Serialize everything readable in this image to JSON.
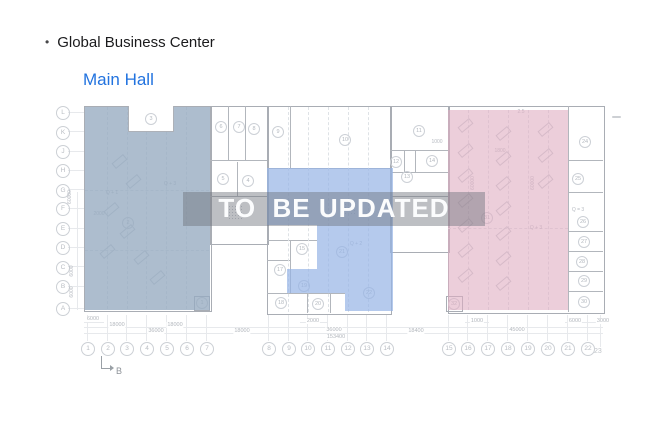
{
  "header": {
    "bullet": "•",
    "title": "Global Business Center",
    "subtitle": "Main Hall"
  },
  "watermark": "TO  BE UPDATED",
  "grid": {
    "letters": [
      "L",
      "K",
      "J",
      "H",
      "G",
      "F",
      "E",
      "D",
      "C",
      "B",
      "A"
    ],
    "numbers": [
      "1",
      "2",
      "3",
      "4",
      "5",
      "6",
      "7",
      "8",
      "9",
      "10",
      "11",
      "12",
      "13",
      "14",
      "15",
      "16",
      "17",
      "18",
      "19",
      "20",
      "21",
      "22",
      "23"
    ]
  },
  "rooms": {
    "r1": "1",
    "r2": "2",
    "r3": "3",
    "r4": "4",
    "r5": "5",
    "r6": "6",
    "r7": "7",
    "r8": "8",
    "r9": "9",
    "r10": "10",
    "r11": "11",
    "r12": "12",
    "r13": "13",
    "r14": "14",
    "r15": "15",
    "r17": "17",
    "r18": "18",
    "r19": "19",
    "r20": "20",
    "r21": "21",
    "r22": "22",
    "r24": "24",
    "r25": "25",
    "r26": "26",
    "r27": "27",
    "r28": "28",
    "r29": "29",
    "r30": "30",
    "r31": "31",
    "r32": "32"
  },
  "area_labels": {
    "left_a": "Q + 3",
    "left_b": "Q + 1",
    "middle": "Q + 2",
    "pink": "Q + 3",
    "right_col": "Q = 3"
  },
  "dims": {
    "left_offset": "6000",
    "left_seg1": "18000",
    "left_seg2": "18000",
    "left_total": "36000",
    "gap_left": "18000",
    "mid_2000": "2000",
    "mid_total": "36000",
    "overall": "153400",
    "gap_right": "18400",
    "right_1000": "1000",
    "right_total": "45000",
    "right_6000": "6000",
    "right_3000": "3000",
    "v_60000_left": "60000",
    "v_6000_a": "6000",
    "v_6000_b": "6000",
    "v_60000_p1": "60000",
    "v_60000_p2": "60000",
    "pink_1800": "1800",
    "white_1000": "1000",
    "pink_25": "2.5",
    "left_2000": "2000"
  },
  "section_marker": "B",
  "colors": {
    "subtitle_blue": "#2273df",
    "overlay_left": "#b6c2cf",
    "overlay_middle": "#b7caeb",
    "overlay_pink": "#eccdd8",
    "watermark_band": "#6c727a",
    "watermark_text": "#fbfcfd"
  }
}
